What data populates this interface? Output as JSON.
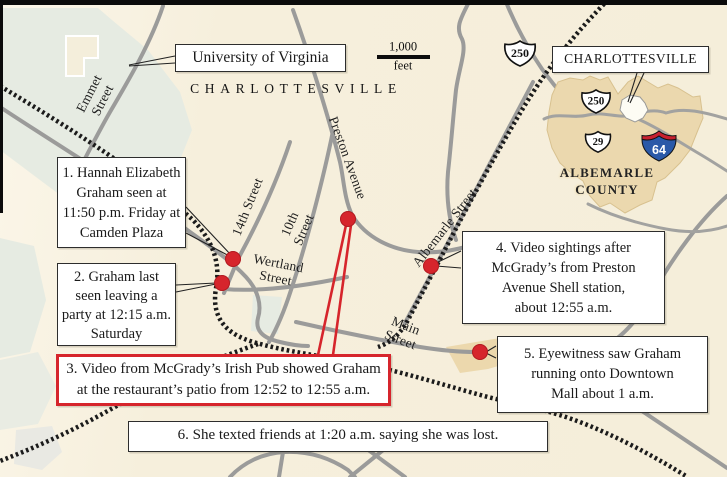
{
  "map_labels": {
    "city": "CHARLOTTESVILLE",
    "university": "University of Virginia",
    "streets": {
      "emmet": [
        "Emmet",
        "Street"
      ],
      "preston": "Preston Avenue",
      "fourteenth": "14th Street",
      "tenth": [
        "10th",
        "Street"
      ],
      "wertland": [
        "Wertland",
        "Street"
      ],
      "albemarle": "Albemarle Street",
      "main": [
        "Main",
        "Street"
      ]
    }
  },
  "scale_bar": {
    "value": "1,000",
    "unit": "feet"
  },
  "route_shields": {
    "us250_main": "250"
  },
  "inset": {
    "city_label": "CHARLOTTESVILLE",
    "county": [
      "ALBEMARLE",
      "COUNTY"
    ],
    "us250": "250",
    "us29": "29",
    "i64": "64"
  },
  "callouts": [
    {
      "id": 1,
      "lines": [
        "1. Hannah Elizabeth",
        "Graham seen at",
        "11:50 p.m. Friday at",
        "Camden Plaza"
      ]
    },
    {
      "id": 2,
      "lines": [
        "2. Graham last",
        "seen leaving a",
        "party at 12:15 a.m.",
        "Saturday"
      ]
    },
    {
      "id": 3,
      "lines": [
        "3. Video from McGrady’s Irish Pub showed Graham",
        "at the restaurant’s patio from 12:52 to 12:55 a.m."
      ]
    },
    {
      "id": 4,
      "lines": [
        "4. Video sightings after",
        "McGrady’s from Preston",
        "Avenue Shell station,",
        "about 12:55 a.m."
      ]
    },
    {
      "id": 5,
      "lines": [
        "5. Eyewitness saw Graham",
        "running onto Downtown",
        "Mall about 1 a.m."
      ]
    },
    {
      "id": 6,
      "lines": [
        "6. She texted friends at 1:20 a.m. saying she was lost."
      ]
    }
  ],
  "colors": {
    "accent_red": "#d6252c",
    "map_background": "#f6efdc",
    "road_gray": "#9b9b9a",
    "campus_green": "#e6ebe2",
    "county_tan": "#ebd8ae",
    "railroad_black": "#1b1b1b"
  }
}
